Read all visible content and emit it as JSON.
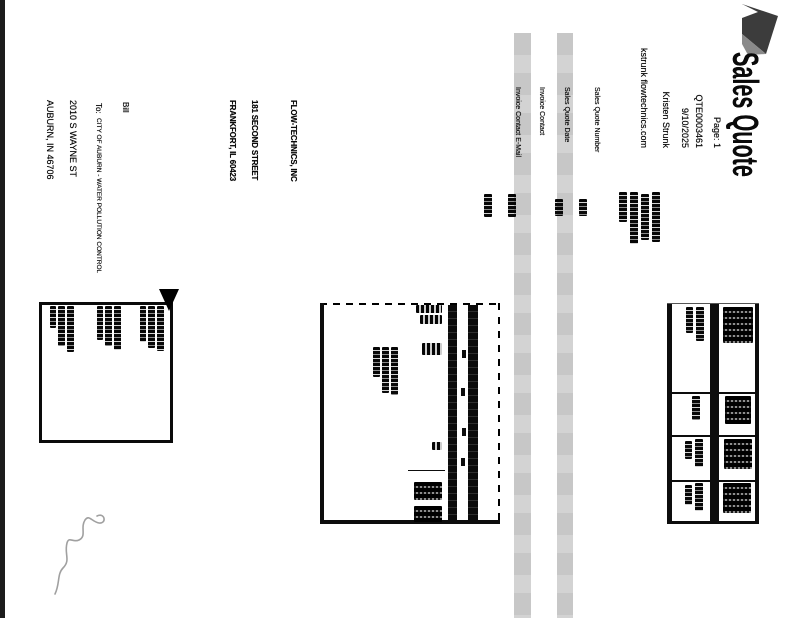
{
  "scan": {
    "orientation_note": "document scanned rotated 90 degrees clockwise",
    "title": "Sales Quote",
    "meta_lines": [
      "Page: 1",
      "QTE0003461",
      "9/10/2025",
      "Kristen Strunk",
      "kstrunk  flowtechnics.com"
    ],
    "field_labels": [
      "Sales Quote Number",
      "Sales Quote Date",
      "Invoice Contact",
      "Invoice Contact E-Mail"
    ],
    "company_address": [
      "FLOW-TECHNICS, INC",
      "181 SECOND STREET",
      "FRANKFORT, IL 60423"
    ],
    "bill_to": {
      "prefix": "Bill",
      "to_label": "To:",
      "lines": [
        "CITY OF AUBURN - WATER POLLUTION CONTROL",
        "2010 S WAYNE ST",
        "AUBURN, IN 46706"
      ]
    },
    "illegible_regions": [
      "four-column header table at top right (bold headers + value row)",
      "line-item table: header band, one item row with qty/price/amount, wrapped description",
      "boxed comment area at bottom with short text lines and arrow marker",
      "handwritten ink annotations near header fields",
      "light pencil signature scribble at bottom right"
    ],
    "colors": {
      "paper": "#ffffff",
      "ink": "#0a0a0a",
      "stripe_gray": "#c9c9c9",
      "pencil_gray": "#a0a0a0",
      "logo_dark": "#3c3c3c",
      "logo_mid": "#8a8a8a"
    }
  }
}
